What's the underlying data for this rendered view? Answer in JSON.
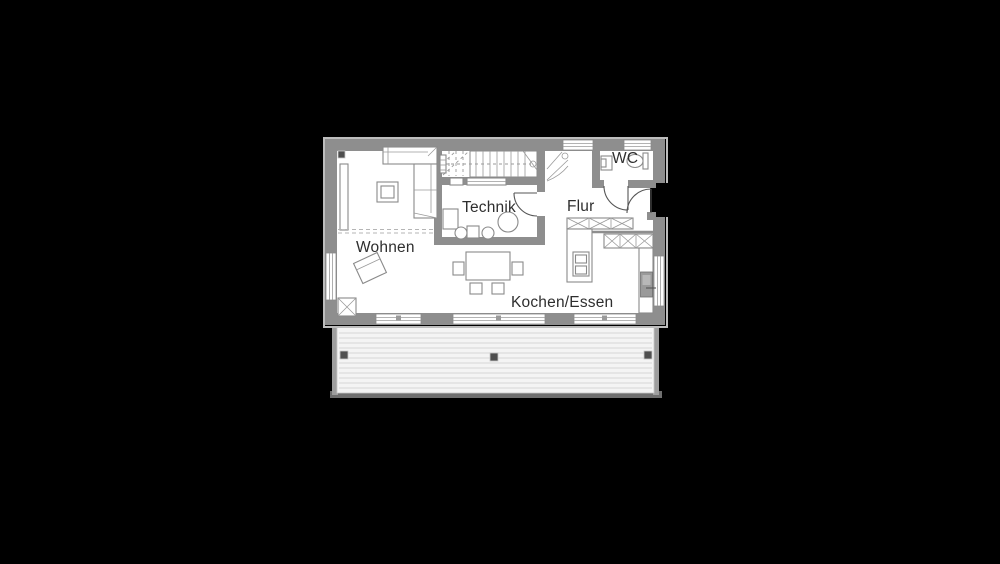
{
  "image_type": "architectural-floor-plan",
  "labels": {
    "wohnen": "Wohnen",
    "technik": "Technik",
    "flur": "Flur",
    "wc": "WC",
    "kochen_essen": "Kochen/Essen"
  },
  "colors": {
    "background": "#000000",
    "wall": "#8e8e8e",
    "wall_outline": "#bdbdbd",
    "floor": "#ffffff",
    "furniture_line": "#8a8a8a",
    "label_text": "#2e2e2e",
    "terrace_fill": "#f4f4f4",
    "terrace_plank_line": "#e0e0e0",
    "terrace_edge": "#9e9e9e",
    "post": "#4f4f4f"
  }
}
